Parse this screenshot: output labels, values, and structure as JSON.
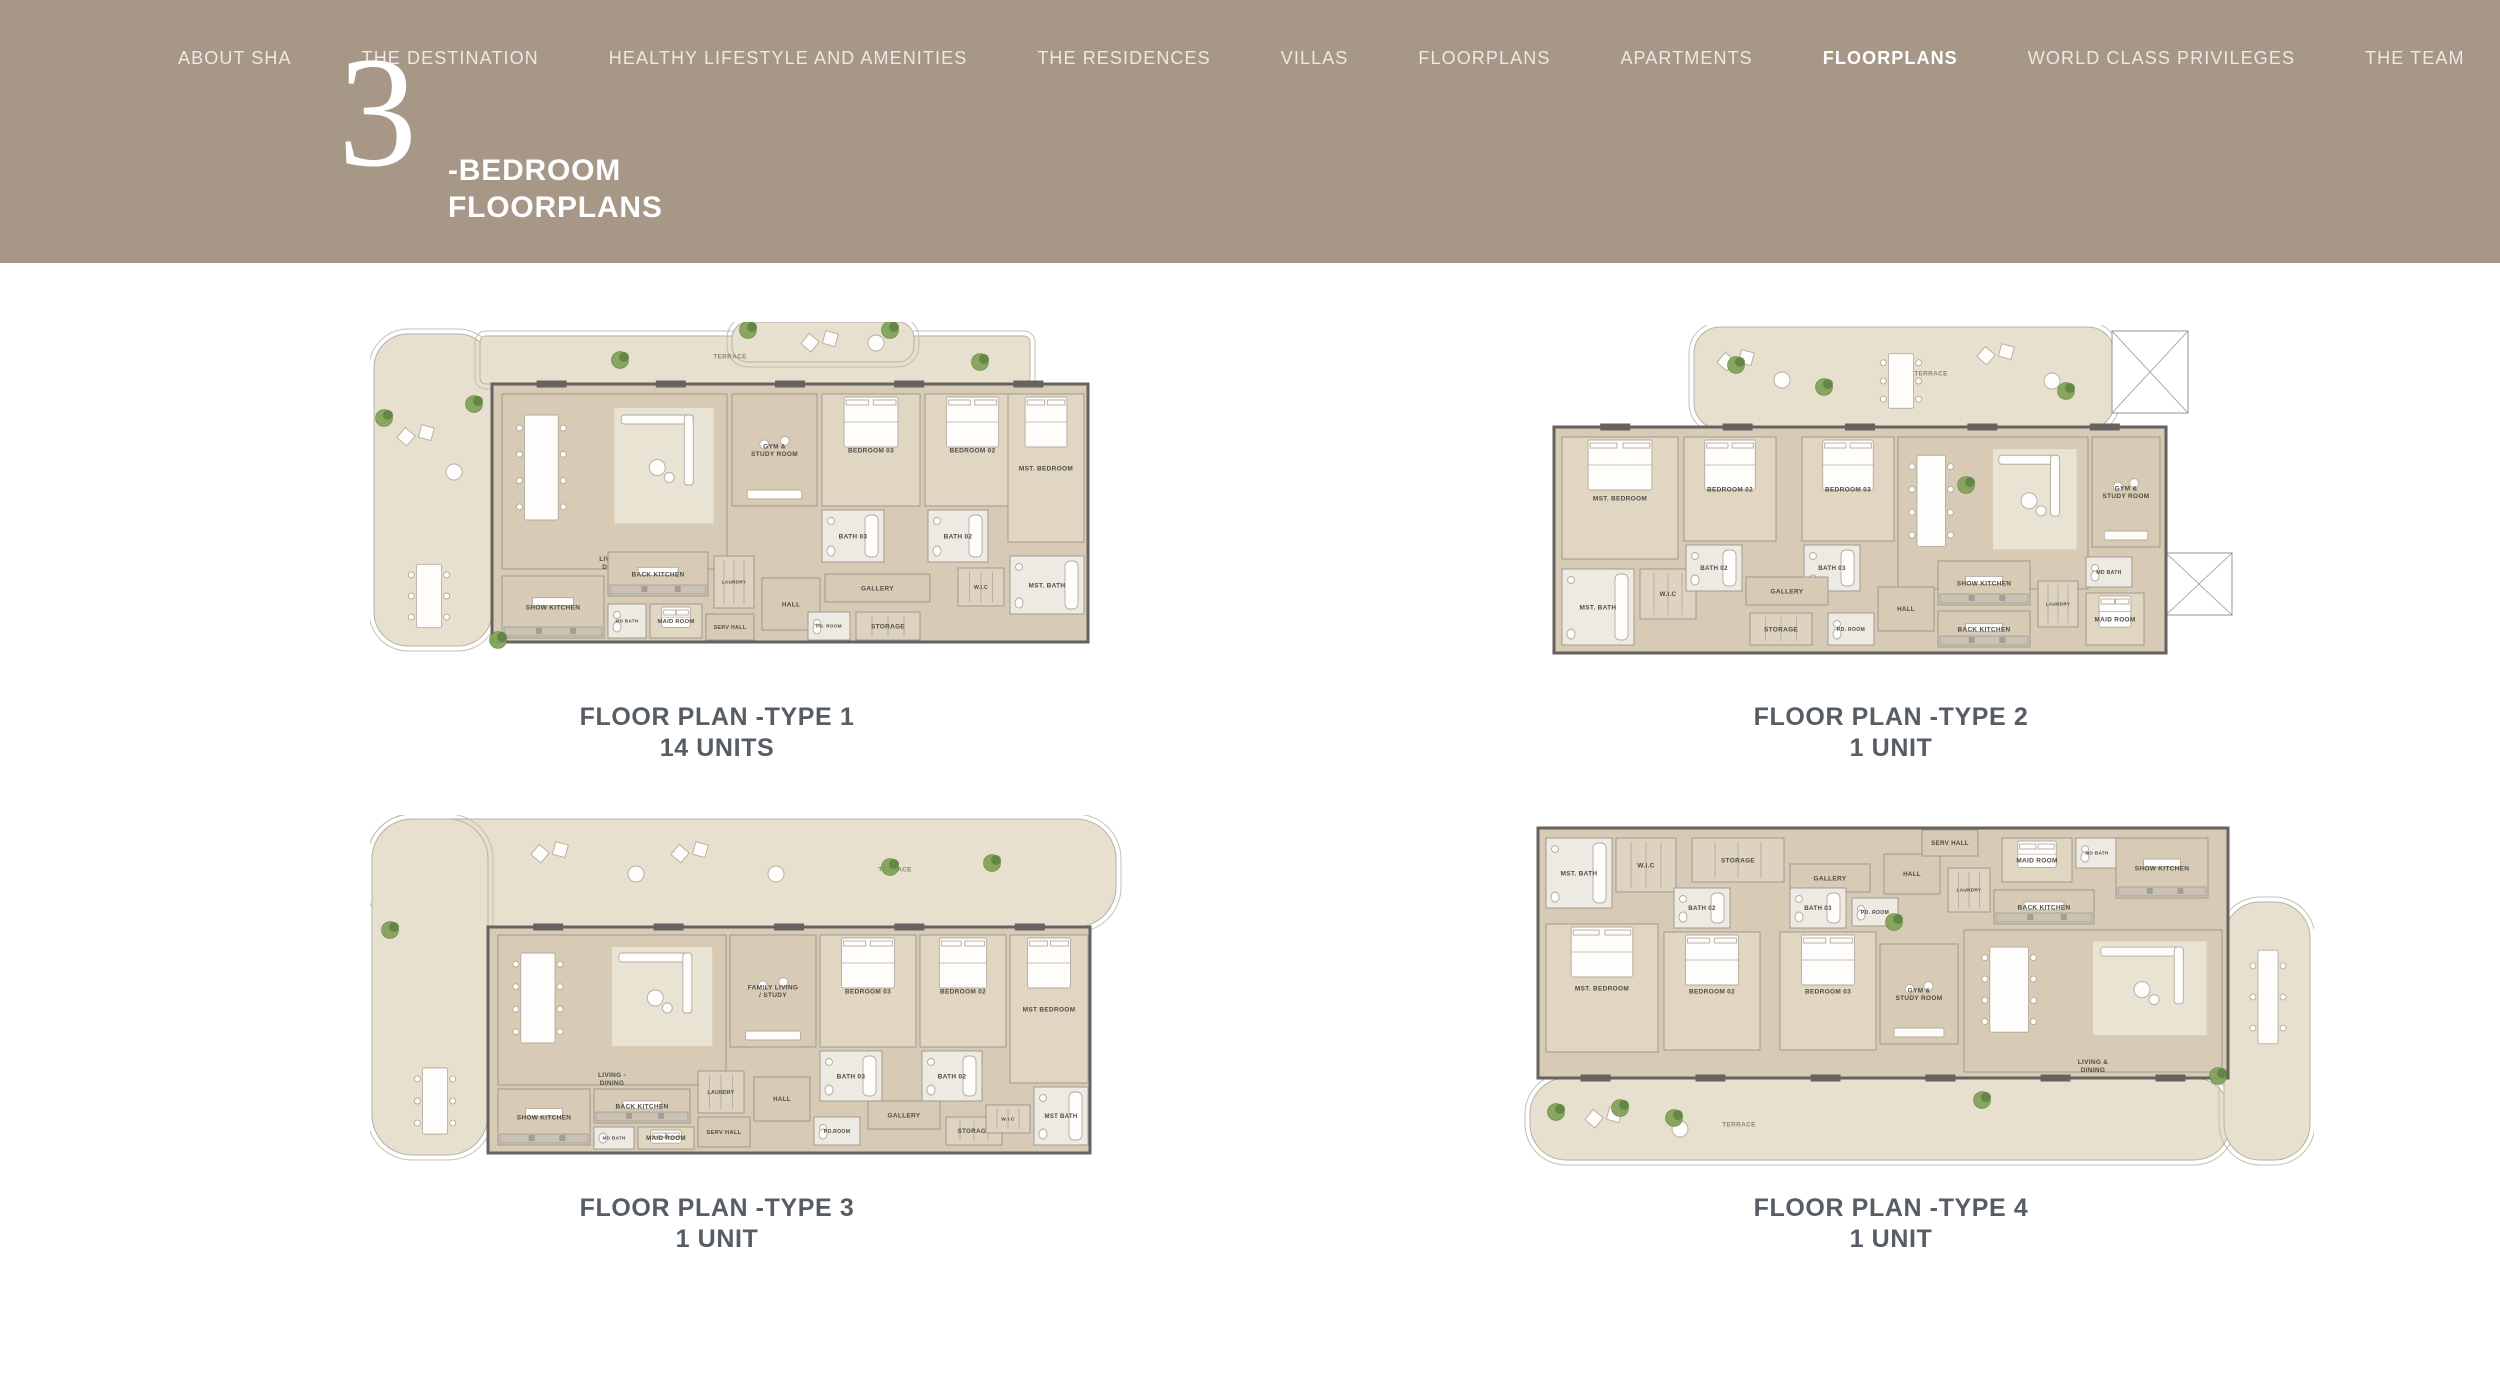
{
  "header": {
    "background_color": "#a79787",
    "nav": [
      {
        "label": "ABOUT SHA",
        "active": false
      },
      {
        "label": "THE DESTINATION",
        "active": false
      },
      {
        "label": "HEALTHY LIFESTYLE AND AMENITIES",
        "active": false
      },
      {
        "label": "THE RESIDENCES",
        "active": false
      },
      {
        "label": "VILLAS",
        "active": false
      },
      {
        "label": "FLOORPLANS",
        "active": false
      },
      {
        "label": "APARTMENTS",
        "active": false
      },
      {
        "label": "FLOORPLANS",
        "active": true
      },
      {
        "label": "WORLD CLASS PRIVILEGES",
        "active": false
      },
      {
        "label": "THE TEAM",
        "active": false
      }
    ],
    "title": {
      "numeral": "3",
      "line1": "-BEDROOM",
      "line2": "FLOORPLANS"
    }
  },
  "palette": {
    "header_bg": "#a79787",
    "caption": "#575d64",
    "terrace": "#e8e0cf",
    "floor": "#d7cbb6",
    "bedroom": "#e0d6c2",
    "bath": "#edeae3",
    "rug": "#e9e3d4",
    "wall": "#666260",
    "outline": "#b6b1a8",
    "room_line": "#9a948a",
    "counter": "#c9c2b5",
    "furn_fill": "#fefdfb",
    "furn_stroke": "#b3ab9e",
    "green_dark": "#5e8142",
    "green_light": "#83a35a",
    "label": "#4e4d45",
    "terrace_label": "#8d8575",
    "void_fill": "#ffffff"
  },
  "plans": [
    {
      "caption": "FLOOR PLAN -TYPE 1",
      "units": "14 UNITS",
      "w": 790,
      "h": 340,
      "dx": 48,
      "win": "top",
      "terrace": [
        {
          "x": 4,
          "y": 12,
          "w": 118,
          "h": 312,
          "rx": 34
        },
        {
          "x": 110,
          "y": 14,
          "w": 550,
          "h": 48,
          "rx": 6
        },
        {
          "x": 362,
          "y": 0,
          "w": 182,
          "h": 40,
          "rx": 16
        }
      ],
      "voids": [],
      "floor": [
        {
          "x": 122,
          "y": 62,
          "w": 596,
          "h": 258
        }
      ],
      "rooms": [
        [
          "LIVING & DINING",
          132,
          72,
          225,
          175,
          "living"
        ],
        [
          "GYM & STUDY ROOM",
          362,
          72,
          85,
          112,
          "study"
        ],
        [
          "BEDROOM 03",
          452,
          72,
          98,
          112
        ],
        [
          "BEDROOM 02",
          555,
          72,
          95,
          112
        ],
        [
          "MST. BEDROOM",
          638,
          72,
          76,
          148
        ],
        [
          "BATH 03",
          452,
          188,
          62,
          52
        ],
        [
          "BATH 02",
          558,
          188,
          60,
          52
        ],
        [
          "GALLERY",
          455,
          252,
          105,
          28,
          "plain"
        ],
        [
          "W.I.C",
          588,
          246,
          46,
          38,
          "closet"
        ],
        [
          "MST. BATH",
          640,
          234,
          74,
          58
        ],
        [
          "BACK KITCHEN",
          238,
          230,
          100,
          44,
          "kitchen"
        ],
        [
          "SHOW KITCHEN",
          132,
          254,
          102,
          62,
          "kitchen"
        ],
        [
          "LAUNDRY",
          344,
          234,
          40,
          52,
          "closet"
        ],
        [
          "HALL",
          392,
          256,
          58,
          52,
          "plain"
        ],
        [
          "MD BATH",
          238,
          282,
          38,
          34
        ],
        [
          "MAID ROOM",
          280,
          282,
          52,
          34
        ],
        [
          "SERV HALL",
          336,
          292,
          48,
          26,
          "plain"
        ],
        [
          "PD. ROOM",
          438,
          290,
          42,
          28
        ],
        [
          "STORAGE",
          486,
          290,
          64,
          28,
          "closet"
        ],
        [
          "TERRACE",
          300,
          22,
          120,
          24,
          "label"
        ],
        [
          "",
          26,
          100,
          72,
          100,
          "tlounge"
        ],
        [
          "",
          24,
          230,
          70,
          88,
          "tdining"
        ],
        [
          "",
          430,
          6,
          90,
          30,
          "tlounge"
        ]
      ],
      "plants": [
        [
          14,
          96
        ],
        [
          104,
          82
        ],
        [
          250,
          38
        ],
        [
          378,
          8
        ],
        [
          520,
          8
        ],
        [
          610,
          40
        ],
        [
          128,
          318
        ]
      ]
    },
    {
      "caption": "FLOOR PLAN -TYPE 2",
      "units": "1 UNIT",
      "w": 690,
      "h": 335,
      "dx": 0,
      "win": "top",
      "terrace": [
        {
          "x": 148,
          "y": 2,
          "w": 420,
          "h": 102,
          "rx": 26
        }
      ],
      "voids": [
        {
          "x": 566,
          "y": 6,
          "w": 76,
          "h": 82
        },
        {
          "x": 620,
          "y": 228,
          "w": 66,
          "h": 62
        }
      ],
      "floor": [
        {
          "x": 8,
          "y": 102,
          "w": 612,
          "h": 226
        }
      ],
      "rooms": [
        [
          "MST. BEDROOM",
          16,
          112,
          116,
          122
        ],
        [
          "BEDROOM 02",
          138,
          112,
          92,
          104
        ],
        [
          "BEDROOM 03",
          256,
          112,
          92,
          104
        ],
        [
          "LIVING & DINING",
          352,
          112,
          190,
          152,
          "living"
        ],
        [
          "GYM & STUDY ROOM",
          546,
          112,
          68,
          110,
          "study"
        ],
        [
          "MST. BATH",
          16,
          244,
          72,
          76
        ],
        [
          "W.I.C",
          94,
          244,
          56,
          50,
          "closet"
        ],
        [
          "BATH 02",
          140,
          220,
          56,
          46
        ],
        [
          "BATH 03",
          258,
          220,
          56,
          46
        ],
        [
          "GALLERY",
          200,
          252,
          82,
          28,
          "plain"
        ],
        [
          "STORAGE",
          204,
          288,
          62,
          32,
          "closet"
        ],
        [
          "PD. ROOM",
          282,
          288,
          46,
          32
        ],
        [
          "HALL",
          332,
          262,
          56,
          44,
          "plain"
        ],
        [
          "SHOW KITCHEN",
          392,
          236,
          92,
          44,
          "kitchen"
        ],
        [
          "BACK KITCHEN",
          392,
          286,
          92,
          36,
          "kitchen"
        ],
        [
          "LAUNDRY",
          492,
          256,
          40,
          46,
          "closet"
        ],
        [
          "MD BATH",
          540,
          232,
          46,
          30
        ],
        [
          "MAID ROOM",
          540,
          268,
          58,
          52
        ],
        [
          "TERRACE",
          330,
          36,
          110,
          24,
          "label"
        ],
        [
          "",
          170,
          22,
          80,
          66,
          "tlounge"
        ],
        [
          "",
          320,
          18,
          70,
          76,
          "tdining"
        ],
        [
          "",
          430,
          16,
          90,
          80,
          "tlounge"
        ]
      ],
      "plants": [
        [
          278,
          62
        ],
        [
          520,
          66
        ],
        [
          420,
          160
        ],
        [
          190,
          40
        ]
      ]
    },
    {
      "caption": "FLOOR PLAN -TYPE 3",
      "units": "1 UNIT",
      "w": 770,
      "h": 350,
      "dx": 38,
      "win": "top",
      "terrace": [
        {
          "x": 2,
          "y": 4,
          "w": 744,
          "h": 108,
          "rx": 40
        },
        {
          "x": 2,
          "y": 4,
          "w": 116,
          "h": 336,
          "rx": 40
        }
      ],
      "voids": [],
      "floor": [
        {
          "x": 118,
          "y": 112,
          "w": 602,
          "h": 226
        }
      ],
      "rooms": [
        [
          "LIVING - DINING",
          128,
          120,
          228,
          150,
          "living"
        ],
        [
          "FAMILY LIVING / STUDY",
          360,
          120,
          86,
          112,
          "study"
        ],
        [
          "BEDROOM 03",
          450,
          120,
          96,
          112
        ],
        [
          "BEDROOM 02",
          550,
          120,
          86,
          112
        ],
        [
          "MST BEDROOM",
          640,
          120,
          78,
          148
        ],
        [
          "BATH 03",
          450,
          236,
          62,
          50
        ],
        [
          "BATH 02",
          552,
          236,
          60,
          50
        ],
        [
          "SHOW KITCHEN",
          128,
          274,
          92,
          56,
          "kitchen"
        ],
        [
          "BACK KITCHEN",
          224,
          274,
          96,
          34,
          "kitchen"
        ],
        [
          "MD BATH",
          224,
          312,
          40,
          22
        ],
        [
          "MAID ROOM",
          268,
          312,
          56,
          22
        ],
        [
          "SERV HALL",
          328,
          302,
          52,
          30,
          "plain"
        ],
        [
          "LAUNDRY",
          328,
          256,
          46,
          42,
          "closet"
        ],
        [
          "HALL",
          384,
          262,
          56,
          44,
          "plain"
        ],
        [
          "PD.ROOM",
          444,
          302,
          46,
          28
        ],
        [
          "GALLERY",
          498,
          286,
          72,
          28,
          "plain"
        ],
        [
          "STORAGE",
          576,
          302,
          56,
          28,
          "closet"
        ],
        [
          "W.I.C",
          616,
          290,
          44,
          28,
          "closet"
        ],
        [
          "MST BATH",
          664,
          272,
          54,
          58
        ],
        [
          "TERRACE",
          470,
          42,
          110,
          24,
          "label"
        ],
        [
          "",
          160,
          24,
          120,
          70,
          "tlounge"
        ],
        [
          "",
          300,
          24,
          120,
          70,
          "tlounge"
        ],
        [
          "",
          30,
          240,
          70,
          92,
          "tdining"
        ]
      ],
      "plants": [
        [
          520,
          52
        ],
        [
          622,
          48
        ],
        [
          20,
          115
        ]
      ]
    },
    {
      "caption": "FLOOR PLAN -TYPE 4",
      "units": "1 UNIT",
      "w": 790,
      "h": 355,
      "dx": 28,
      "win": "bottom",
      "terrace": [
        {
          "x": 6,
          "y": 266,
          "w": 700,
          "h": 82,
          "rx": 36
        },
        {
          "x": 700,
          "y": 90,
          "w": 86,
          "h": 258,
          "rx": 36
        }
      ],
      "voids": [],
      "floor": [
        {
          "x": 14,
          "y": 16,
          "w": 690,
          "h": 250
        }
      ],
      "rooms": [
        [
          "MST. BATH",
          22,
          26,
          66,
          70
        ],
        [
          "W.I.C",
          92,
          26,
          60,
          54,
          "closet"
        ],
        [
          "STORAGE",
          168,
          26,
          92,
          44,
          "closet"
        ],
        [
          "GALLERY",
          266,
          52,
          80,
          28,
          "plain"
        ],
        [
          "MST. BEDROOM",
          22,
          112,
          112,
          128
        ],
        [
          "BEDROOM 02",
          140,
          120,
          96,
          118
        ],
        [
          "BEDROOM 03",
          256,
          120,
          96,
          118
        ],
        [
          "BATH 02",
          150,
          76,
          56,
          40
        ],
        [
          "BATH 03",
          266,
          76,
          56,
          40
        ],
        [
          "PD. ROOM",
          328,
          86,
          46,
          28
        ],
        [
          "GYM & STUDY ROOM",
          356,
          132,
          78,
          100,
          "study"
        ],
        [
          "HALL",
          360,
          42,
          56,
          40,
          "plain"
        ],
        [
          "SERV HALL",
          398,
          18,
          56,
          26,
          "plain"
        ],
        [
          "LAUNDRY",
          424,
          56,
          42,
          44,
          "closet"
        ],
        [
          "MAID ROOM",
          478,
          26,
          70,
          44
        ],
        [
          "MD BATH",
          552,
          26,
          42,
          30
        ],
        [
          "BACK KITCHEN",
          470,
          78,
          100,
          34,
          "kitchen"
        ],
        [
          "SHOW KITCHEN",
          592,
          26,
          92,
          60,
          "kitchen"
        ],
        [
          "LIVING & DINING",
          440,
          118,
          258,
          142,
          "living"
        ],
        [
          "TERRACE",
          160,
          300,
          110,
          24,
          "label"
        ],
        [
          "",
          716,
          120,
          56,
          130,
          "tdining"
        ],
        [
          "",
          60,
          292,
          110,
          50,
          "tlounge"
        ]
      ],
      "plants": [
        [
          32,
          300
        ],
        [
          96,
          296
        ],
        [
          150,
          306
        ],
        [
          458,
          288
        ],
        [
          694,
          264
        ],
        [
          370,
          110
        ]
      ]
    }
  ]
}
